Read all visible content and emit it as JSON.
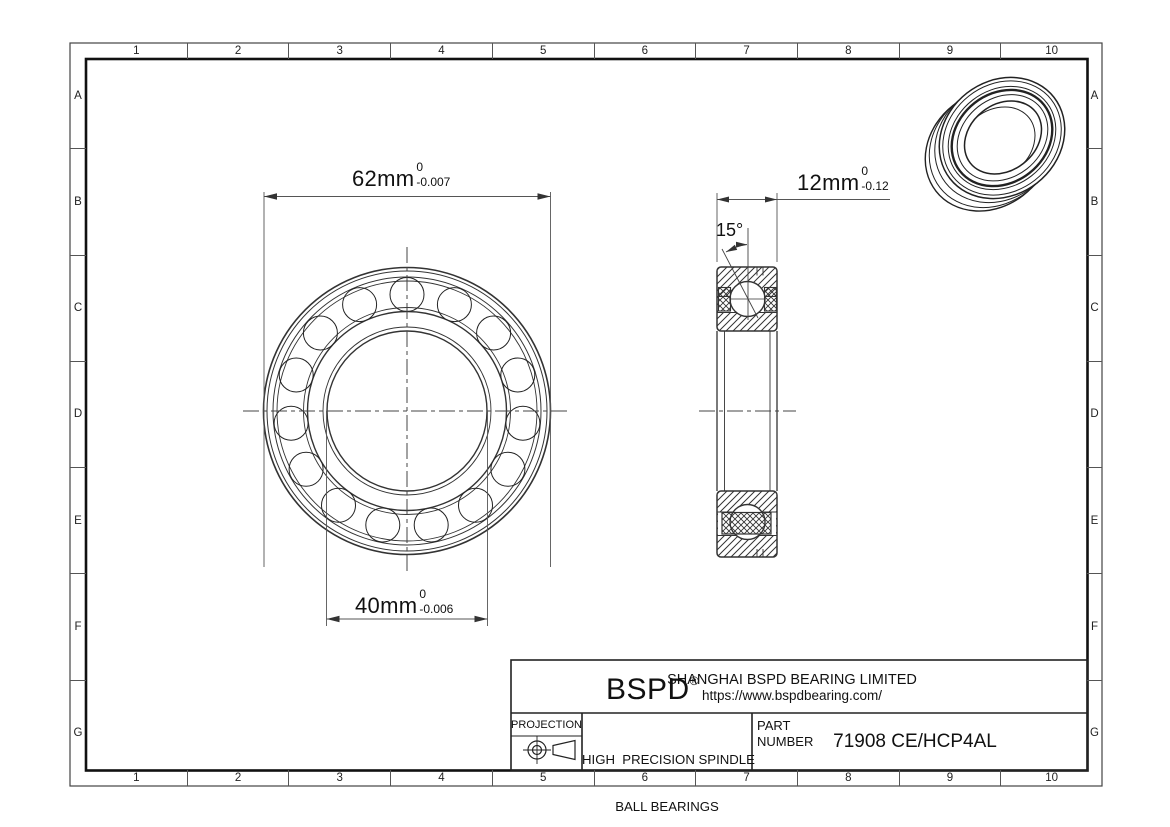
{
  "grid": {
    "columns": [
      "1",
      "2",
      "3",
      "4",
      "5",
      "6",
      "7",
      "8",
      "9",
      "10"
    ],
    "rows": [
      "A",
      "B",
      "C",
      "D",
      "E",
      "F",
      "G"
    ]
  },
  "front_view": {
    "outer_dim": {
      "value": "62mm",
      "tol_upper": "0",
      "tol_lower": "-0.007"
    },
    "bore_dim": {
      "value": "40mm",
      "tol_upper": "0",
      "tol_lower": "-0.006"
    }
  },
  "side_view": {
    "width_dim": {
      "value": "12mm",
      "tol_upper": "0",
      "tol_lower": "-0.12"
    },
    "contact_angle": "15°"
  },
  "title_block": {
    "logo": "BSPD",
    "logo_mark": "®",
    "company": "SHANGHAI BSPD BEARING LIMITED",
    "website": "https://www.bspdbearing.com/",
    "projection_label": "PROJECTION",
    "product_line1": "HIGH  PRECISION SPINDLE",
    "product_line2": "BALL BEARINGS",
    "part_label_line1": "PART",
    "part_label_line2": "NUMBER",
    "part_number": "71908 CE/HCP4AL"
  },
  "colors": {
    "line": "#222222",
    "thin_line": "#555555",
    "background": "#ffffff"
  }
}
